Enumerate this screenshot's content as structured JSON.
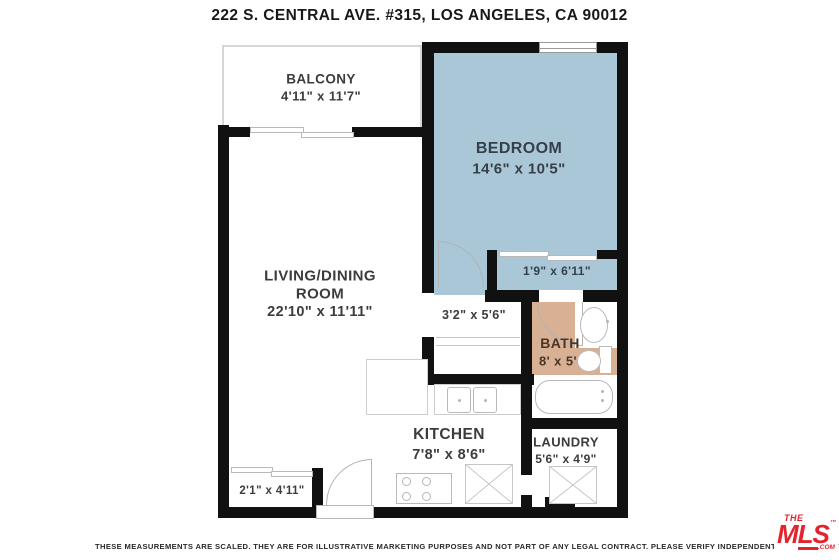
{
  "title": "222 S. CENTRAL AVE. #315, LOS ANGELES, CA 90012",
  "rooms": {
    "balcony": {
      "name": "BALCONY",
      "dims": "4'11\" x 11'7\""
    },
    "bedroom": {
      "name": "BEDROOM",
      "dims": "14'6\" x 10'5\""
    },
    "living_dining": {
      "name_line1": "LIVING/DINING",
      "name_line2": "ROOM",
      "dims": "22'10\" x 11'11\""
    },
    "bedroom_closet": {
      "dims": "1'9\" x 6'11\""
    },
    "hall_closet": {
      "dims": "3'2\" x 5'6\""
    },
    "bath": {
      "name": "BATH",
      "dims": "8' x 5'"
    },
    "kitchen": {
      "name": "KITCHEN",
      "dims": "7'8\" x 8'6\""
    },
    "laundry": {
      "name": "LAUNDRY",
      "dims": "5'6\" x 4'9\""
    },
    "entry_closet": {
      "dims": "2'1\" x 4'11\""
    }
  },
  "footer": {
    "disclaimer": "THESE MEASUREMENTS ARE SCALED.  THEY ARE FOR ILLUSTRATIVE MARKETING PURPOSES AND NOT PART OF ANY LEGAL CONTRACT.  PLEASE VERIFY INDEPENDENTLY.",
    "copyright": "© HILLARY CANAB",
    "logo": {
      "the": "THE",
      "mls": "MLS",
      "tm": "™",
      "com": ".COM"
    }
  },
  "colors": {
    "bedroom_fill": "#a9c7d7",
    "bath_fill": "#d8b194",
    "wall": "#111111",
    "logo_red": "#e5232b"
  }
}
